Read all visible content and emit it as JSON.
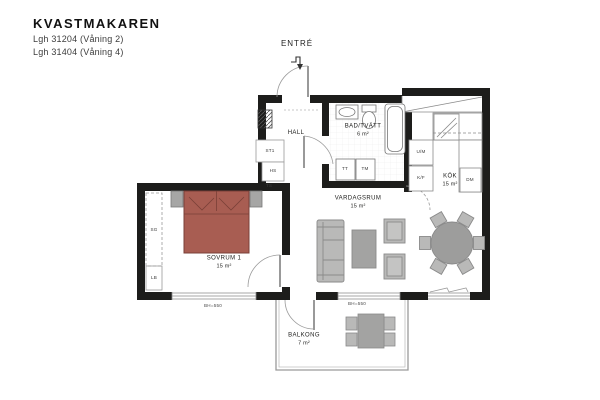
{
  "title": "KVASTMAKAREN",
  "apartment": {
    "line1": "Lgh 31204 (Våning 2)",
    "line2": "Lgh 31404 (Våning 4)"
  },
  "entrance": {
    "label": "ENTRÉ"
  },
  "rooms": {
    "hall": {
      "name": "HALL"
    },
    "bathroom": {
      "name": "BAD/TVÄTT",
      "area": "6 m²"
    },
    "kitchen": {
      "name": "KÖK",
      "area": "15 m²"
    },
    "living_room": {
      "name": "VARDAGSRUM",
      "area": "15 m²"
    },
    "bedroom": {
      "name": "SOVRUM 1",
      "area": "15 m²"
    },
    "balcony": {
      "name": "BALKONG",
      "area": "7 m²"
    }
  },
  "fixtures": {
    "oven_microwave": "U/M",
    "fridge_freezer": "K/F",
    "dishwasher": "DM",
    "tumble_dryer": "TT",
    "washing_machine": "TM",
    "sliding_wardrobe": "SG",
    "linen_cabinet": "LB",
    "cleaning_cabinet": "ST1",
    "tall_cabinet": "HS",
    "drying_cabinet": "TS"
  },
  "windows": {
    "bedroom_sill": "BH=550",
    "balcony_sill": "BH=550"
  },
  "colors": {
    "wall": "#1d1d1b",
    "bed_fill": "#a85d52",
    "bed_outline": "#7a4038",
    "furniture_fill": "#b9b9b8",
    "furniture_dark": "#a3a3a2",
    "thin_line": "#8a8a8a"
  }
}
